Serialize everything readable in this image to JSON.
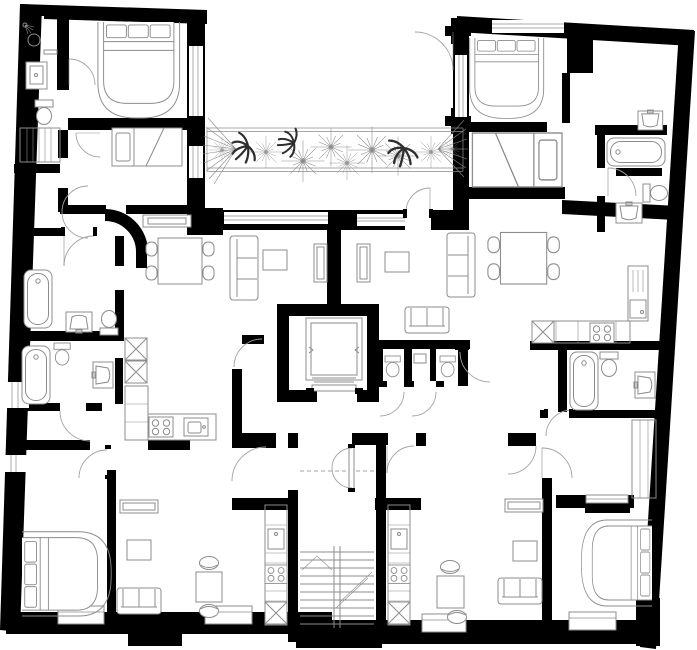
{
  "plan": {
    "label": "Apartment building floor plan",
    "colors": {
      "background": "#ffffff",
      "wall": "#000000",
      "line": "#8c8c8c",
      "door": "#a3a3a3",
      "plant": "#8a8a8a",
      "plant_dark": "#2e2e2e"
    },
    "regions": {
      "terrace": "planted terrace",
      "core": "elevator and stair core"
    },
    "counts": {
      "double_beds": 4,
      "small_beds": 2,
      "bathtubs": 4,
      "kitchens": 4,
      "dining_tables": 2,
      "small_tables": 2,
      "sofas": 5,
      "trees": 9,
      "ferns": 3,
      "toilets": 7,
      "sinks": 9,
      "stairs": 1,
      "elevators": 1
    }
  }
}
